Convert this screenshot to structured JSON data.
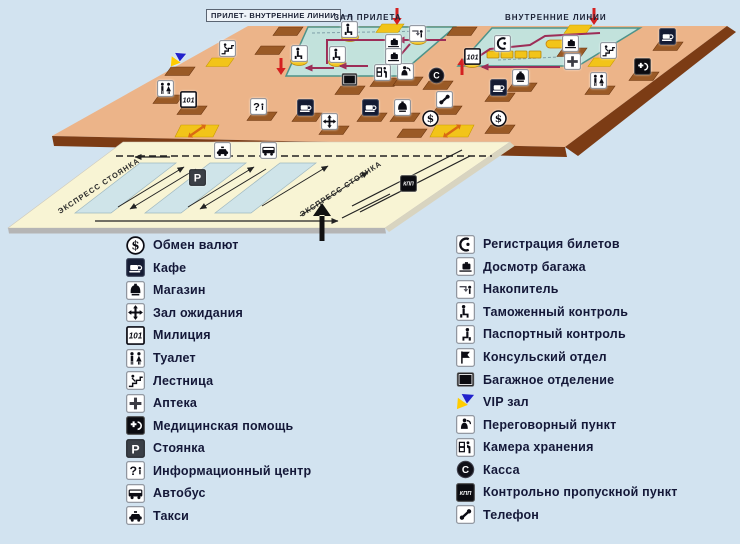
{
  "colors": {
    "background": "#d2e3f0",
    "floor": "#ecb489",
    "floor_edge": "#7c3c15",
    "hall": "#c2e2dc",
    "hall_border": "#4d938a",
    "counter_yellow": "#f2c419",
    "mat_brown": "#9a5a26",
    "parking_lot": "#f8f4d4",
    "parking_strip": "#cfe4e9",
    "path_magenta": "#9c2d57",
    "arrow_red": "#d42020",
    "vip_blue": "#2222cc",
    "vip_yellow": "#ffcc00",
    "legend_text": "#141838"
  },
  "map": {
    "labels": {
      "boxed": "ПРИЛЕТ- ВНУТРЕННИЕ ЛИНИИ",
      "arrival": "ЗАЛ  ПРИЛЕТА",
      "domestic": "ВНУТРЕННИЕ  ЛИНИИ"
    },
    "parking": {
      "express_left": "ЭКСПРЕСС СТОЯНКА",
      "express_right": "ЭКСПРЕСС СТОЯНКА"
    },
    "icons": [
      {
        "icon": "vip",
        "x": 178,
        "y": 60
      },
      {
        "icon": "stairs",
        "x": 227,
        "y": 48
      },
      {
        "icon": "toilet",
        "x": 165,
        "y": 88
      },
      {
        "icon": "police101",
        "x": 188,
        "y": 99
      },
      {
        "icon": "info",
        "x": 258,
        "y": 106
      },
      {
        "icon": "cafe",
        "x": 305,
        "y": 107
      },
      {
        "icon": "waiting",
        "x": 329,
        "y": 121
      },
      {
        "icon": "cafe",
        "x": 370,
        "y": 107
      },
      {
        "icon": "shop",
        "x": 402,
        "y": 107
      },
      {
        "icon": "phone",
        "x": 444,
        "y": 99
      },
      {
        "icon": "dollar",
        "x": 430,
        "y": 118
      },
      {
        "icon": "dollar",
        "x": 498,
        "y": 118
      },
      {
        "icon": "kassa",
        "x": 436,
        "y": 75
      },
      {
        "icon": "kamera",
        "x": 382,
        "y": 72
      },
      {
        "icon": "peregovorny",
        "x": 405,
        "y": 71
      },
      {
        "icon": "bagdept",
        "x": 349,
        "y": 79
      },
      {
        "icon": "bagcheck",
        "x": 570,
        "y": 43
      },
      {
        "icon": "cafe",
        "x": 667,
        "y": 36
      },
      {
        "icon": "stairs",
        "x": 608,
        "y": 50
      },
      {
        "icon": "pharmacy",
        "x": 572,
        "y": 61
      },
      {
        "icon": "medical",
        "x": 642,
        "y": 66
      },
      {
        "icon": "toilet",
        "x": 598,
        "y": 80
      },
      {
        "icon": "customs",
        "x": 299,
        "y": 53
      },
      {
        "icon": "customs",
        "x": 337,
        "y": 54
      },
      {
        "icon": "customs",
        "x": 349,
        "y": 29
      },
      {
        "icon": "nakopitel",
        "x": 417,
        "y": 33
      },
      {
        "icon": "bagcheck",
        "x": 393,
        "y": 42
      },
      {
        "icon": "bagcheck",
        "x": 393,
        "y": 56
      },
      {
        "icon": "registration",
        "x": 502,
        "y": 43
      },
      {
        "icon": "police101",
        "x": 472,
        "y": 56
      },
      {
        "icon": "shop",
        "x": 520,
        "y": 77
      },
      {
        "icon": "cafe",
        "x": 498,
        "y": 87
      },
      {
        "icon": "taxi",
        "x": 222,
        "y": 150
      },
      {
        "icon": "bus",
        "x": 268,
        "y": 150
      },
      {
        "icon": "parking",
        "x": 197,
        "y": 177
      },
      {
        "icon": "kpp",
        "x": 408,
        "y": 183
      }
    ]
  },
  "legend": {
    "left": [
      {
        "icon": "dollar",
        "label": "Обмен валют"
      },
      {
        "icon": "cafe",
        "label": "Кафе"
      },
      {
        "icon": "shop",
        "label": "Магазин"
      },
      {
        "icon": "waiting",
        "label": "Зал ожидания"
      },
      {
        "icon": "police101",
        "label": "Милиция"
      },
      {
        "icon": "toilet",
        "label": "Туалет"
      },
      {
        "icon": "stairs",
        "label": "Лестница"
      },
      {
        "icon": "pharmacy",
        "label": "Аптека"
      },
      {
        "icon": "medical",
        "label": "Медицинская помощь"
      },
      {
        "icon": "parking",
        "label": "Стоянка"
      },
      {
        "icon": "info",
        "label": "Информационный центр"
      },
      {
        "icon": "bus",
        "label": "Автобус"
      },
      {
        "icon": "taxi",
        "label": "Такси"
      }
    ],
    "right": [
      {
        "icon": "registration",
        "label": "Регистрация билетов"
      },
      {
        "icon": "bagcheck",
        "label": "Досмотр багажа"
      },
      {
        "icon": "nakopitel",
        "label": "Накопитель"
      },
      {
        "icon": "customs",
        "label": "Таможенный контроль"
      },
      {
        "icon": "passport",
        "label": "Паспортный контроль"
      },
      {
        "icon": "consular",
        "label": "Консульский отдел"
      },
      {
        "icon": "bagdept",
        "label": "Багажное отделение"
      },
      {
        "icon": "vip",
        "label": "VIP зал"
      },
      {
        "icon": "peregovorny",
        "label": "Переговорный пункт"
      },
      {
        "icon": "kamera",
        "label": "Камера хранения"
      },
      {
        "icon": "kassa",
        "label": "Касса"
      },
      {
        "icon": "kpp",
        "label": "Контрольно пропускной пункт"
      },
      {
        "icon": "phone",
        "label": "Телефон"
      }
    ]
  }
}
